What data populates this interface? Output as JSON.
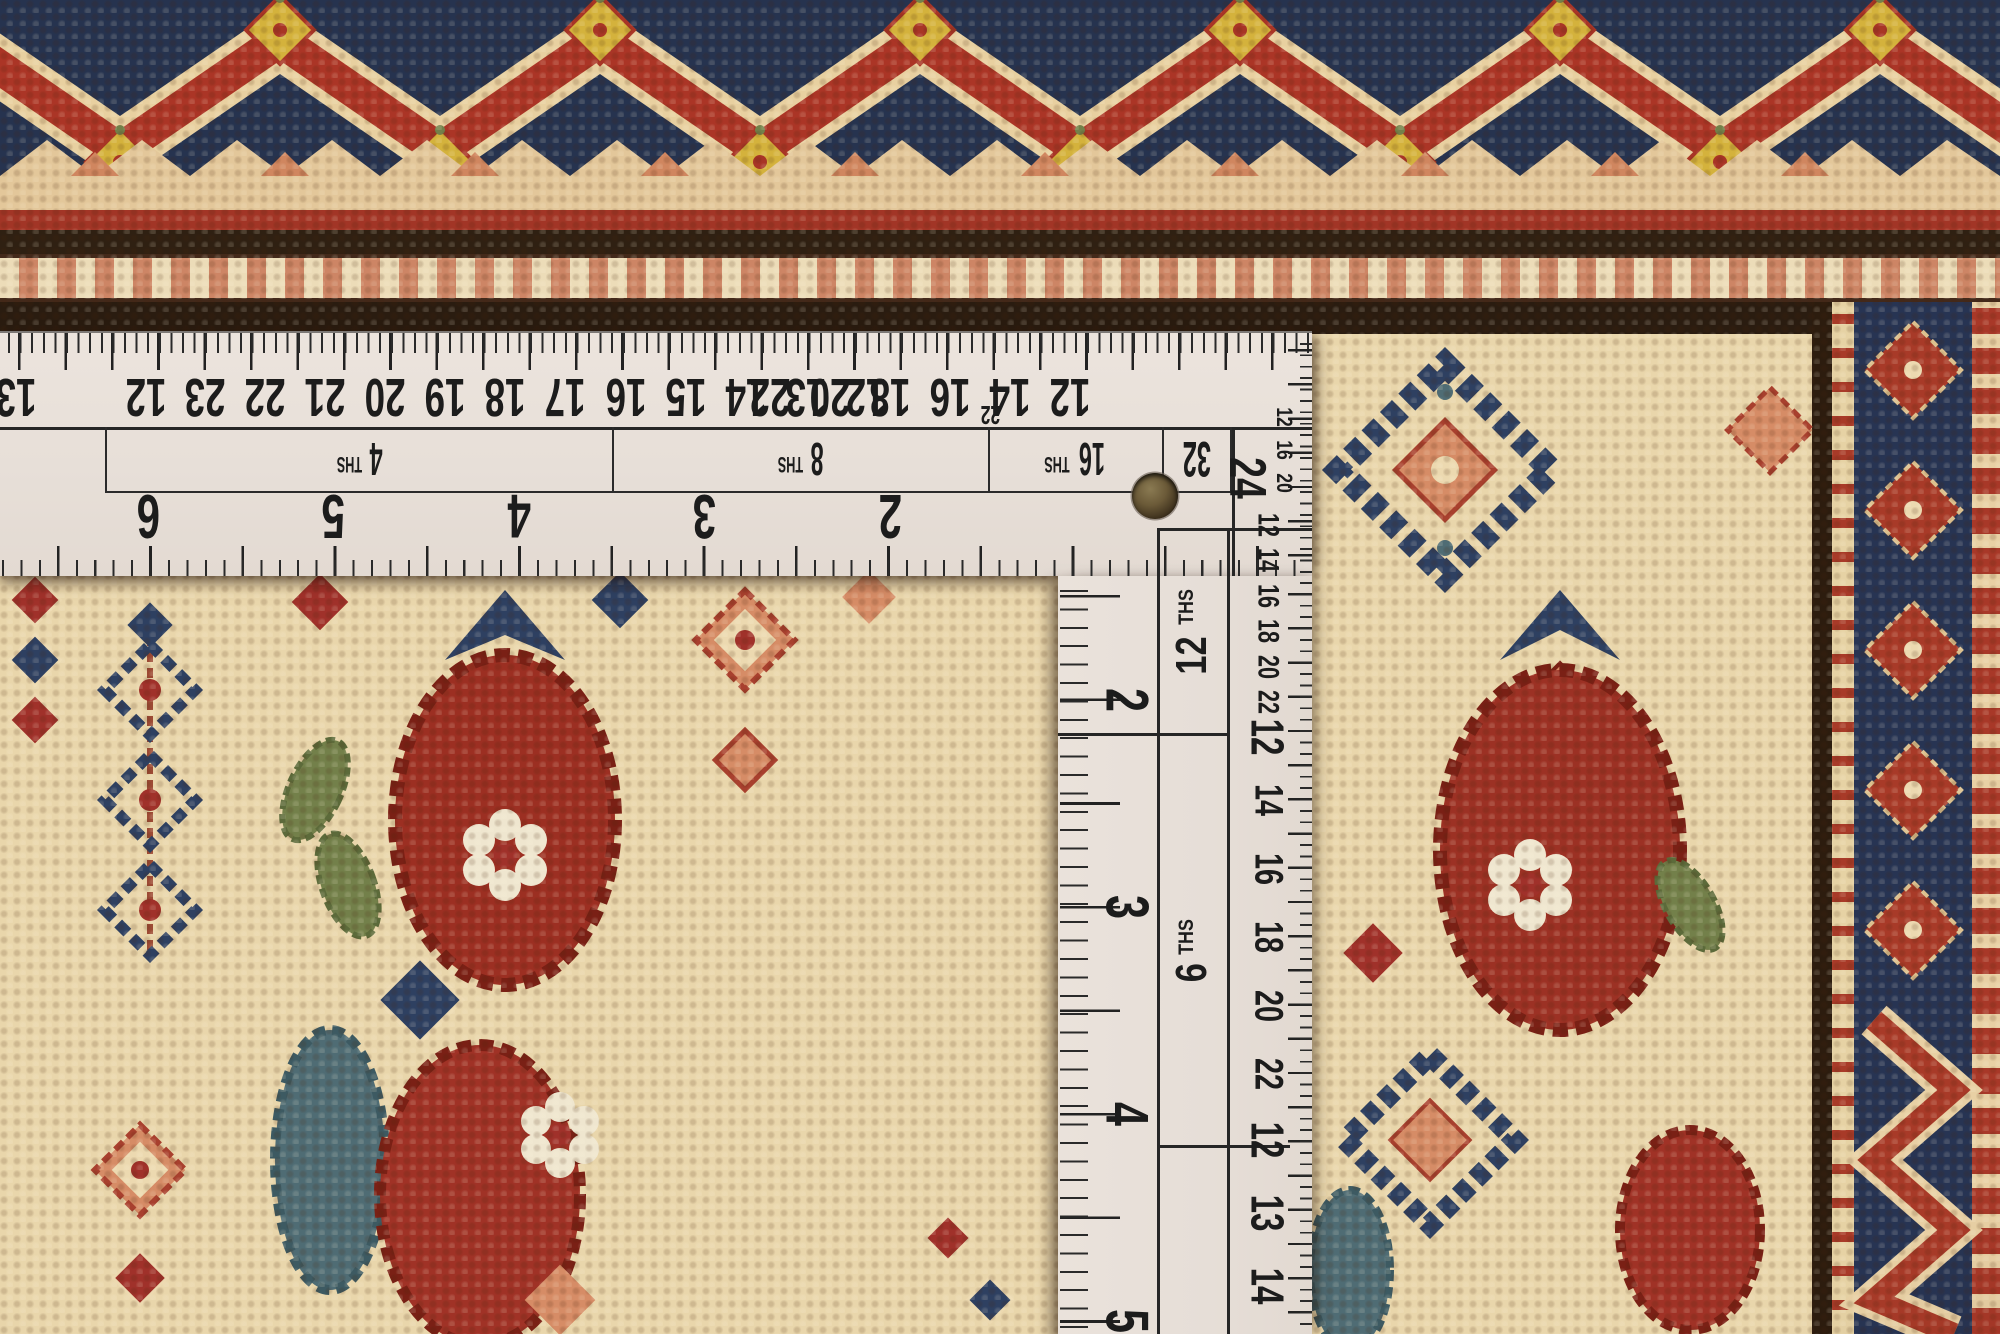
{
  "ruler": {
    "horizontal_arm": {
      "top_scale_4ths_numbers": [
        "13",
        "12"
      ],
      "top_scale_8ths_numbers": [
        "23",
        "22",
        "21",
        "20",
        "19",
        "18",
        "17",
        "16",
        "15",
        "14",
        "13",
        "12"
      ],
      "top_scale_16ths_numbers": [
        "22",
        "20",
        "18",
        "16",
        "14",
        "12"
      ],
      "top_scale_32nds_number": "22",
      "bottom_scale_numbers": [
        "6",
        "5",
        "4",
        "3",
        "2"
      ],
      "section_labels": {
        "ths4": {
          "num": "4",
          "suffix": "THS"
        },
        "ths8": {
          "num": "8",
          "suffix": "THS"
        },
        "ths16": {
          "num": "16",
          "suffix": "THS"
        },
        "n32": "32",
        "n24": "24"
      },
      "corner_edge_numbers": [
        "12",
        "16",
        "20"
      ]
    },
    "vertical_arm": {
      "section_labels": {
        "ths12": {
          "num": "12",
          "suffix": "THS"
        },
        "ths6": {
          "num": "6",
          "suffix": "THS"
        }
      },
      "left_scale_numbers": [
        "2",
        "3",
        "4",
        "5"
      ],
      "right_scale_upper_numbers": [
        "12",
        "14",
        "16",
        "18",
        "20",
        "22"
      ],
      "right_scale_upper_end_number": "12",
      "right_scale_lower_numbers": [
        "14",
        "16",
        "18",
        "20",
        "22"
      ],
      "right_scale_bottom_numbers": [
        "12",
        "13",
        "14"
      ]
    },
    "colors": {
      "body": "#e9e1da",
      "ink": "#1c1c1c"
    }
  },
  "rug": {
    "colors": {
      "field": "#e9d6ab",
      "navy": "#2e4061",
      "navy_dark": "#273453",
      "red": "#a83527",
      "red_dark": "#9c2f22",
      "salmon": "#d68c66",
      "cream": "#ecd9b0",
      "brown": "#2f2012",
      "yellow": "#d4b23c",
      "green": "#73804a",
      "teal": "#4f6c74"
    }
  }
}
